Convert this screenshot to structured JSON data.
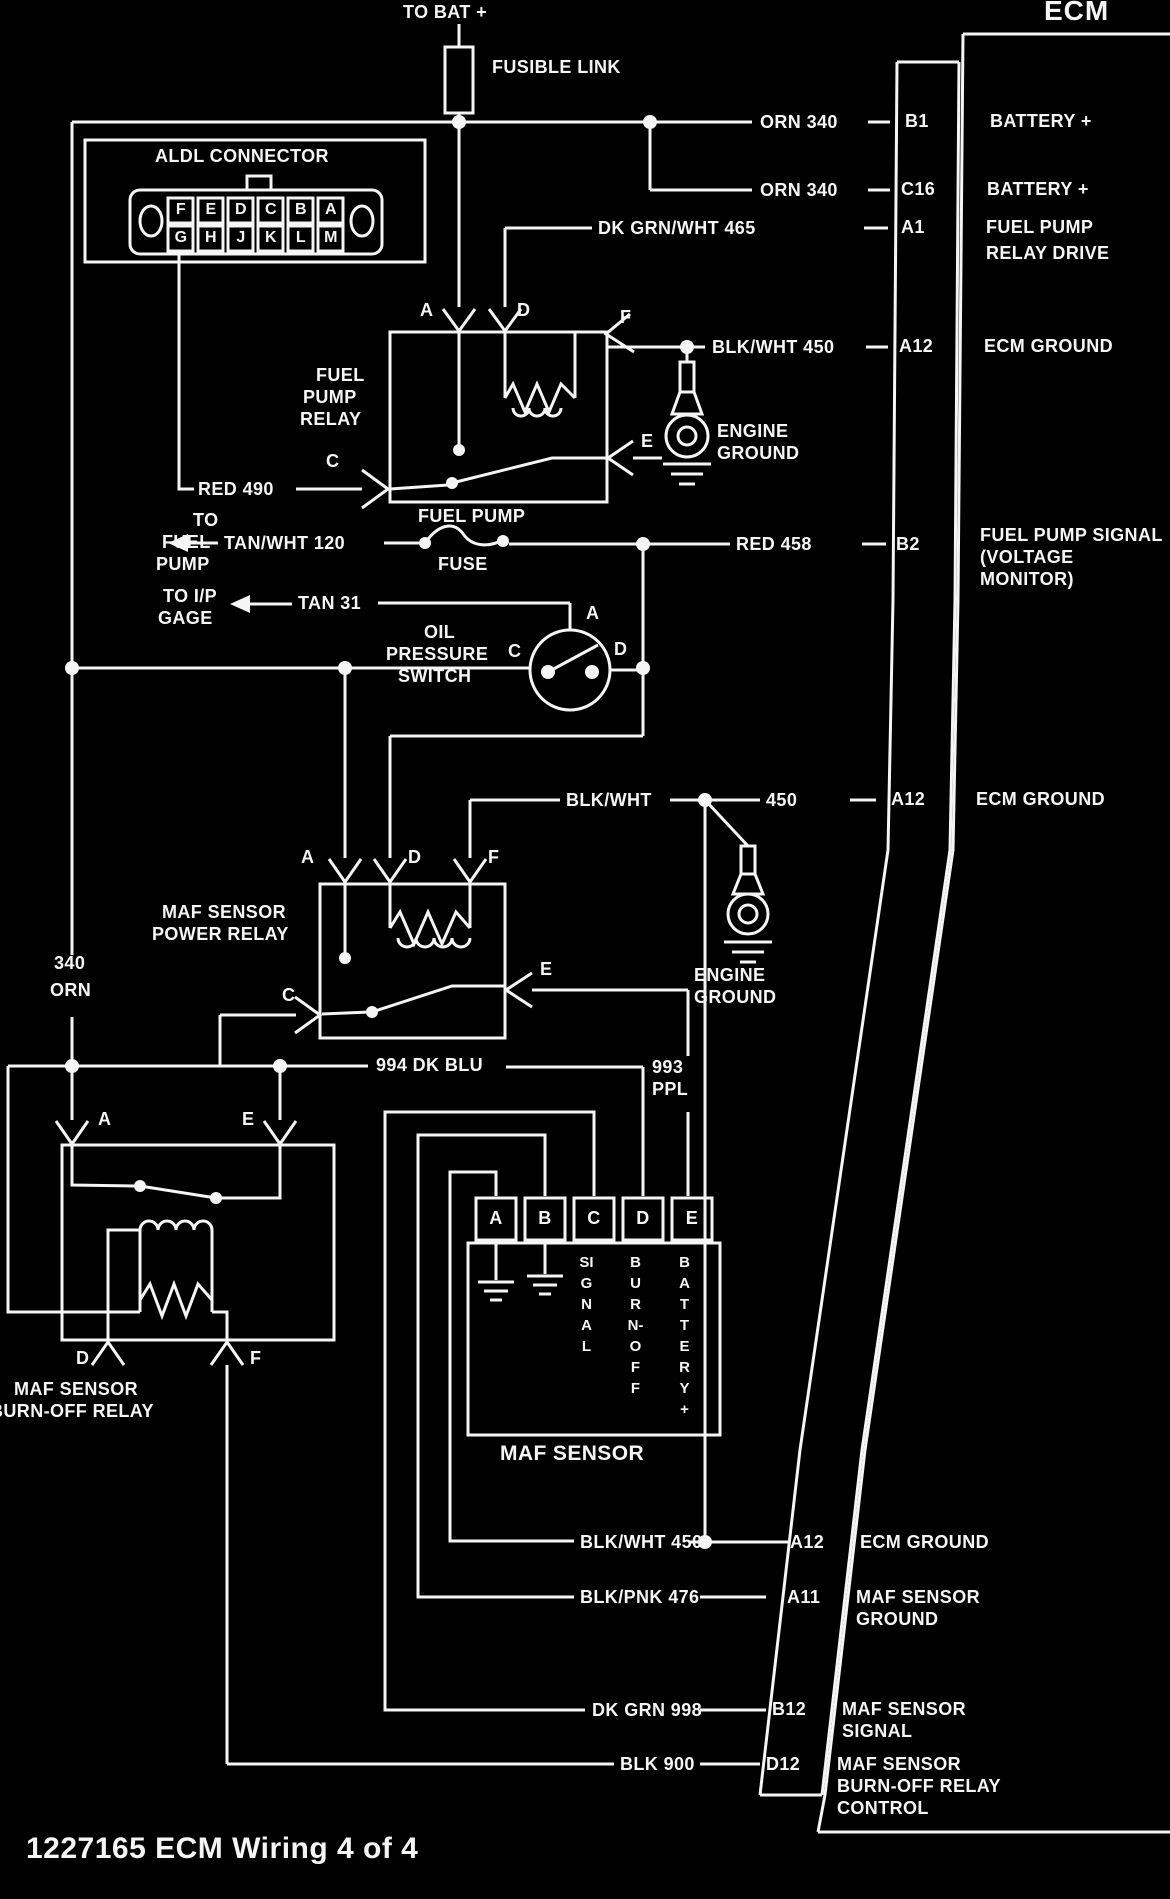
{
  "caption": "1227165 ECM Wiring 4 of 4",
  "top": {
    "to_bat": "TO BAT +",
    "fusible_link": "FUSIBLE LINK"
  },
  "ecm": {
    "title": "ECM",
    "rows": [
      {
        "pin": "B1",
        "label1": "BATTERY +"
      },
      {
        "pin": "C16",
        "label1": "BATTERY +"
      },
      {
        "pin": "A1",
        "label1": "FUEL PUMP",
        "label2": "RELAY DRIVE"
      },
      {
        "pin": "A12",
        "label1": "ECM GROUND"
      },
      {
        "pin": "B2",
        "label1": "FUEL PUMP SIGNAL",
        "label2": "(VOLTAGE",
        "label3": "MONITOR)"
      },
      {
        "pin": "A12",
        "label1": "ECM GROUND"
      },
      {
        "pin": "A12",
        "label1": "ECM GROUND"
      },
      {
        "pin": "A11",
        "label1": "MAF SENSOR",
        "label2": "GROUND"
      },
      {
        "pin": "B12",
        "label1": "MAF SENSOR",
        "label2": "SIGNAL"
      },
      {
        "pin": "D12",
        "label1": "MAF SENSOR",
        "label2": "BURN-OFF RELAY",
        "label3": "CONTROL"
      }
    ]
  },
  "aldl": {
    "title": "ALDL CONNECTOR",
    "pins_top": [
      "F",
      "E",
      "D",
      "C",
      "B",
      "A"
    ],
    "pins_bottom": [
      "G",
      "H",
      "J",
      "K",
      "L",
      "M"
    ]
  },
  "wires": {
    "orn340": "ORN 340",
    "dkgrnwht465": "DK GRN/WHT 465",
    "blkwht450": "BLK/WHT 450",
    "red490": "RED 490",
    "tanwht120": "TAN/WHT 120",
    "tan31": "TAN 31",
    "red458": "RED 458",
    "blkwht": "BLK/WHT",
    "w450": "450",
    "dkblu994": "994 DK BLU",
    "ppl993a": "993",
    "ppl993b": "PPL",
    "orn340a": "340",
    "orn340b": "ORN",
    "blkpnk476": "BLK/PNK 476",
    "dkgrn998": "DK GRN 998",
    "blk900": "BLK 900"
  },
  "letters": {
    "a": "A",
    "b": "B",
    "c": "C",
    "d": "D",
    "e": "E",
    "f": "F"
  },
  "fuel_pump_relay": {
    "l1": "FUEL",
    "l2": "PUMP",
    "l3": "RELAY"
  },
  "power_relay": {
    "l1": "MAF SENSOR",
    "l2": "POWER RELAY"
  },
  "burnoff_relay": {
    "l1": "MAF SENSOR",
    "l2": "BURN-OFF RELAY"
  },
  "oil_switch": {
    "l1": "OIL",
    "l2": "PRESSURE",
    "l3": "SWITCH"
  },
  "fuse": {
    "l1": "FUEL PUMP",
    "l2": "FUSE"
  },
  "engine_ground": {
    "l1": "ENGINE",
    "l2": "GROUND"
  },
  "dest": {
    "fp1": "TO",
    "fp2": "FUEL",
    "fp3": "PUMP",
    "ip1": "TO I/P",
    "ip2": "GAGE"
  },
  "maf_sensor": {
    "title": "MAF SENSOR",
    "pins": [
      "A",
      "B",
      "C",
      "D",
      "E"
    ],
    "fn_c": "SIGNAL",
    "fn_d": "BURN-OFF",
    "fn_e": "BATTERY+"
  }
}
